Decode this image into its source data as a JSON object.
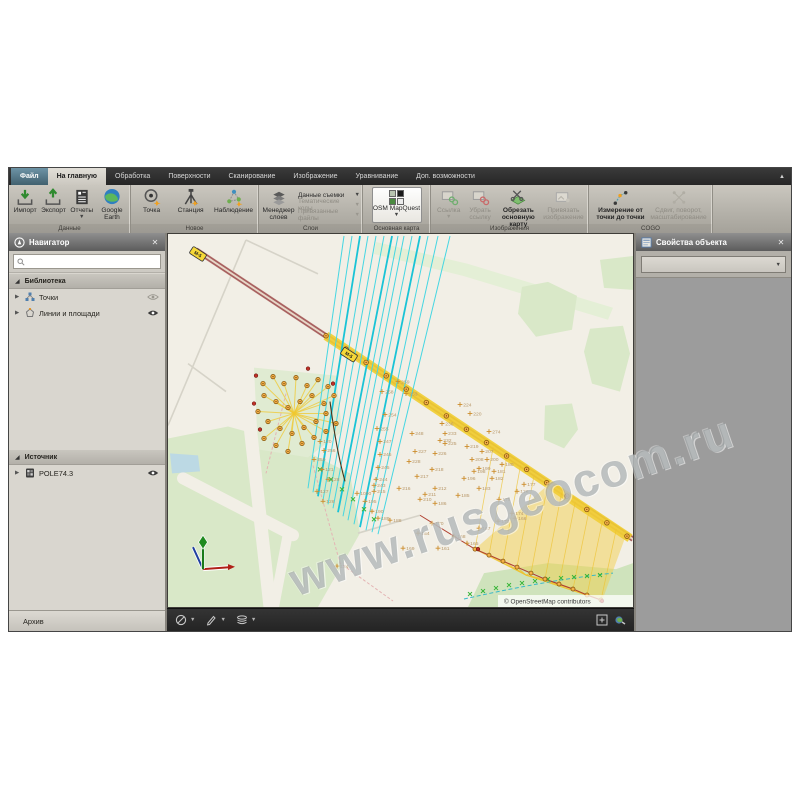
{
  "watermark": {
    "text": "www.rusgeocom.ru"
  },
  "ribbon": {
    "tabs": [
      {
        "label": "Файл"
      },
      {
        "label": "На главную"
      },
      {
        "label": "Обработка"
      },
      {
        "label": "Поверхности"
      },
      {
        "label": "Сканирование"
      },
      {
        "label": "Изображение"
      },
      {
        "label": "Уравнивание"
      },
      {
        "label": "Доп. возможности"
      }
    ],
    "groups": [
      {
        "label": "Данные",
        "buttons": [
          {
            "label": "Импорт"
          },
          {
            "label": "Экспорт"
          },
          {
            "label": "Отчеты"
          },
          {
            "label": "Google Earth"
          }
        ]
      },
      {
        "label": "Новое",
        "buttons": [
          {
            "label": "Точка"
          },
          {
            "label": "Станция"
          },
          {
            "label": "Наблюдение"
          }
        ]
      },
      {
        "label": "Слои",
        "manager_label": "Менеджер слоев",
        "rows": [
          {
            "label": "Данные съемки"
          },
          {
            "label": "Тематические коды"
          },
          {
            "label": "Привязанные файлы"
          }
        ]
      },
      {
        "label": "Основная карта",
        "buttons": [
          {
            "label": "OSM MapQuest"
          }
        ]
      },
      {
        "label": "Изображения",
        "buttons": [
          {
            "label": "Ссылка"
          },
          {
            "label": "Убрать ссылку"
          },
          {
            "label": "Обрезать основную карту"
          },
          {
            "label": "Привязать изображение"
          }
        ]
      },
      {
        "label": "COGO",
        "buttons": [
          {
            "label": "Измерение от точки до точки"
          },
          {
            "label": "Сдвиг, поворот, масштабирование"
          }
        ]
      }
    ]
  },
  "navigator": {
    "title": "Навигатор",
    "library": {
      "label": "Библиотека",
      "items": [
        {
          "label": "Точки"
        },
        {
          "label": "Линии и площади"
        }
      ]
    },
    "source": {
      "label": "Источник",
      "items": [
        {
          "label": "POLE74.3"
        }
      ]
    },
    "archive_label": "Архив"
  },
  "properties": {
    "title": "Свойства объекта",
    "selector_value": ""
  },
  "map": {
    "attribution": "© OpenStreetMap contributors",
    "badges": [
      {
        "label": "М-5",
        "x": 30,
        "y": 20,
        "angle": 33
      },
      {
        "label": "М-5",
        "x": 181,
        "y": 121,
        "angle": 33
      }
    ],
    "trunk": {
      "x1": 28,
      "y1": 16,
      "x2": 465,
      "y2": 306
    },
    "corridor": {
      "x1": 158,
      "y1": 102,
      "x2": 462,
      "y2": 305
    },
    "terrain": [
      {
        "fill": "#d9e8c8",
        "points": "0,205 60,193 122,210 182,240 192,300 150,374 0,374"
      },
      {
        "fill": "#e4efd6",
        "points": "208,8 300,30 445,74 440,86 295,42 206,20"
      },
      {
        "fill": "#d9e8c8",
        "points": "354,53 380,48 409,62 404,96 368,103 350,80"
      },
      {
        "fill": "#d9e8c8",
        "points": "422,95 455,92 462,120 452,158 424,150 416,118"
      },
      {
        "fill": "#d9e8c8",
        "points": "377,172 404,170 410,196 396,215 376,206"
      },
      {
        "fill": "#d9e8c8",
        "points": "432,26 465,22 465,56 436,54"
      },
      {
        "fill": "#e0ebd2",
        "points": "86,134 168,142 174,198 140,224 90,216"
      },
      {
        "fill": "#cfe3bc",
        "points": "300,374 316,340 380,330 448,336 465,330 465,374"
      },
      {
        "fill": "#bcd9e4",
        "points": "2,220 30,222 32,238 4,240"
      }
    ],
    "terrain_paths": [
      {
        "d": "M15,245 L125,302",
        "w": 12
      },
      {
        "d": "M82,192 L102,374",
        "w": 13
      },
      {
        "d": "M120,300 L106,374",
        "w": 10
      }
    ],
    "minor_roads": [
      {
        "d": "M0,192 L78,6"
      },
      {
        "d": "M78,6 L150,40"
      },
      {
        "d": "M20,130 L58,158"
      },
      {
        "d": "M190,300 L252,282"
      }
    ],
    "pink_dashed": [
      {
        "d": "M145,232 L172,330 L225,368"
      },
      {
        "d": "M118,160 L98,240"
      }
    ],
    "dark_curve": {
      "d": "M162,168 Q168,215 177,248"
    },
    "cyan_lines": [
      {
        "x1": 176,
        "y1": 2,
        "x2": 140,
        "y2": 255
      },
      {
        "x1": 184,
        "y1": 2,
        "x2": 145,
        "y2": 259
      },
      {
        "x1": 192,
        "y1": 2,
        "x2": 150,
        "y2": 263
      },
      {
        "x1": 200,
        "y1": 2,
        "x2": 155,
        "y2": 267
      },
      {
        "x1": 208,
        "y1": 2,
        "x2": 160,
        "y2": 271
      },
      {
        "x1": 216,
        "y1": 2,
        "x2": 165,
        "y2": 275
      },
      {
        "x1": 224,
        "y1": 2,
        "x2": 170,
        "y2": 279
      },
      {
        "x1": 230,
        "y1": 2,
        "x2": 175,
        "y2": 283
      },
      {
        "x1": 236,
        "y1": 2,
        "x2": 180,
        "y2": 287
      },
      {
        "x1": 244,
        "y1": 2,
        "x2": 186,
        "y2": 291
      },
      {
        "x1": 252,
        "y1": 2,
        "x2": 192,
        "y2": 294
      },
      {
        "x1": 260,
        "y1": 2,
        "x2": 198,
        "y2": 297
      },
      {
        "x1": 270,
        "y1": 2,
        "x2": 204,
        "y2": 299
      },
      {
        "x1": 282,
        "y1": 2,
        "x2": 210,
        "y2": 301
      }
    ],
    "cluster_circles": [
      [
        95,
        150
      ],
      [
        105,
        143
      ],
      [
        116,
        150
      ],
      [
        128,
        144
      ],
      [
        139,
        152
      ],
      [
        150,
        146
      ],
      [
        160,
        153
      ],
      [
        96,
        162
      ],
      [
        108,
        168
      ],
      [
        120,
        174
      ],
      [
        132,
        168
      ],
      [
        144,
        162
      ],
      [
        156,
        170
      ],
      [
        166,
        162
      ],
      [
        90,
        178
      ],
      [
        100,
        188
      ],
      [
        112,
        195
      ],
      [
        124,
        200
      ],
      [
        136,
        194
      ],
      [
        148,
        188
      ],
      [
        158,
        180
      ],
      [
        96,
        205
      ],
      [
        108,
        212
      ],
      [
        120,
        218
      ],
      [
        134,
        210
      ],
      [
        146,
        204
      ],
      [
        158,
        198
      ],
      [
        168,
        190
      ]
    ],
    "cluster_hub": [
      126,
      180
    ],
    "red_dots": [
      [
        88,
        142
      ],
      [
        86,
        170
      ],
      [
        92,
        196
      ],
      [
        140,
        135
      ],
      [
        165,
        150
      ],
      [
        310,
        316
      ],
      [
        434,
        368
      ]
    ],
    "chain": [
      [
        307,
        316
      ],
      [
        321,
        322
      ],
      [
        335,
        328
      ],
      [
        349,
        334
      ],
      [
        363,
        340
      ],
      [
        377,
        346
      ],
      [
        391,
        351
      ],
      [
        405,
        356
      ],
      [
        419,
        362
      ],
      [
        433,
        367
      ]
    ],
    "fan_apex": [
      358,
      342
    ],
    "fan_poly": "307,316 434,368 458,302 384,248",
    "green_x": [
      [
        302,
        361
      ],
      [
        315,
        358
      ],
      [
        328,
        355
      ],
      [
        341,
        352
      ],
      [
        354,
        350
      ],
      [
        367,
        348
      ],
      [
        380,
        346
      ],
      [
        393,
        345
      ],
      [
        406,
        344
      ],
      [
        419,
        343
      ],
      [
        432,
        342
      ],
      [
        152,
        236
      ],
      [
        163,
        246
      ],
      [
        174,
        256
      ],
      [
        185,
        266
      ],
      [
        196,
        276
      ],
      [
        206,
        286
      ]
    ],
    "teal_dashed": {
      "d": "M296,366 C340,356 390,346 445,340"
    },
    "gizmo": {
      "x": 35,
      "y": 336
    },
    "points": [
      [
        230,
        148,
        "259"
      ],
      [
        214,
        158,
        "258"
      ],
      [
        238,
        160,
        "253"
      ],
      [
        217,
        181,
        "254"
      ],
      [
        209,
        195,
        "255"
      ],
      [
        244,
        200,
        "248"
      ],
      [
        212,
        208,
        "247"
      ],
      [
        212,
        221,
        "246"
      ],
      [
        210,
        234,
        "245"
      ],
      [
        208,
        246,
        "244"
      ],
      [
        206,
        252,
        "243"
      ],
      [
        189,
        260,
        "1000"
      ],
      [
        206,
        258,
        "215"
      ],
      [
        197,
        268,
        "195"
      ],
      [
        204,
        278,
        "190"
      ],
      [
        210,
        285,
        "189"
      ],
      [
        222,
        287,
        "188"
      ],
      [
        274,
        190,
        "236"
      ],
      [
        277,
        200,
        "233"
      ],
      [
        272,
        207,
        "232"
      ],
      [
        241,
        228,
        "228"
      ],
      [
        247,
        218,
        "227"
      ],
      [
        267,
        220,
        "226"
      ],
      [
        277,
        210,
        "225"
      ],
      [
        299,
        213,
        "219"
      ],
      [
        264,
        236,
        "218"
      ],
      [
        249,
        243,
        "217"
      ],
      [
        231,
        255,
        "216"
      ],
      [
        267,
        255,
        "212"
      ],
      [
        257,
        261,
        "211"
      ],
      [
        252,
        266,
        "210"
      ],
      [
        292,
        171,
        "224"
      ],
      [
        302,
        180,
        "220"
      ],
      [
        321,
        198,
        "274"
      ],
      [
        314,
        218,
        "207"
      ],
      [
        304,
        226,
        "208"
      ],
      [
        319,
        226,
        "200"
      ],
      [
        311,
        235,
        "199"
      ],
      [
        306,
        238,
        "198"
      ],
      [
        296,
        245,
        "196"
      ],
      [
        267,
        270,
        "186"
      ],
      [
        290,
        262,
        "185"
      ],
      [
        311,
        255,
        "183"
      ],
      [
        324,
        245,
        "182"
      ],
      [
        326,
        238,
        "181"
      ],
      [
        334,
        231,
        "180"
      ],
      [
        356,
        251,
        "177"
      ],
      [
        349,
        258,
        "176"
      ],
      [
        331,
        266,
        "175"
      ],
      [
        344,
        280,
        "174"
      ],
      [
        330,
        288,
        "173"
      ],
      [
        264,
        290,
        "170"
      ],
      [
        286,
        303,
        "168"
      ],
      [
        311,
        295,
        "167"
      ],
      [
        347,
        285,
        "166"
      ],
      [
        299,
        310,
        "165"
      ],
      [
        156,
        217,
        "256"
      ],
      [
        146,
        226,
        "250"
      ],
      [
        152,
        208,
        "120"
      ],
      [
        154,
        236,
        "121"
      ],
      [
        160,
        246,
        "128"
      ],
      [
        149,
        258,
        "127"
      ],
      [
        155,
        268,
        "126"
      ],
      [
        169,
        333,
        "134"
      ],
      [
        250,
        300,
        "164"
      ],
      [
        270,
        315,
        "161"
      ],
      [
        235,
        315,
        "169"
      ]
    ]
  }
}
